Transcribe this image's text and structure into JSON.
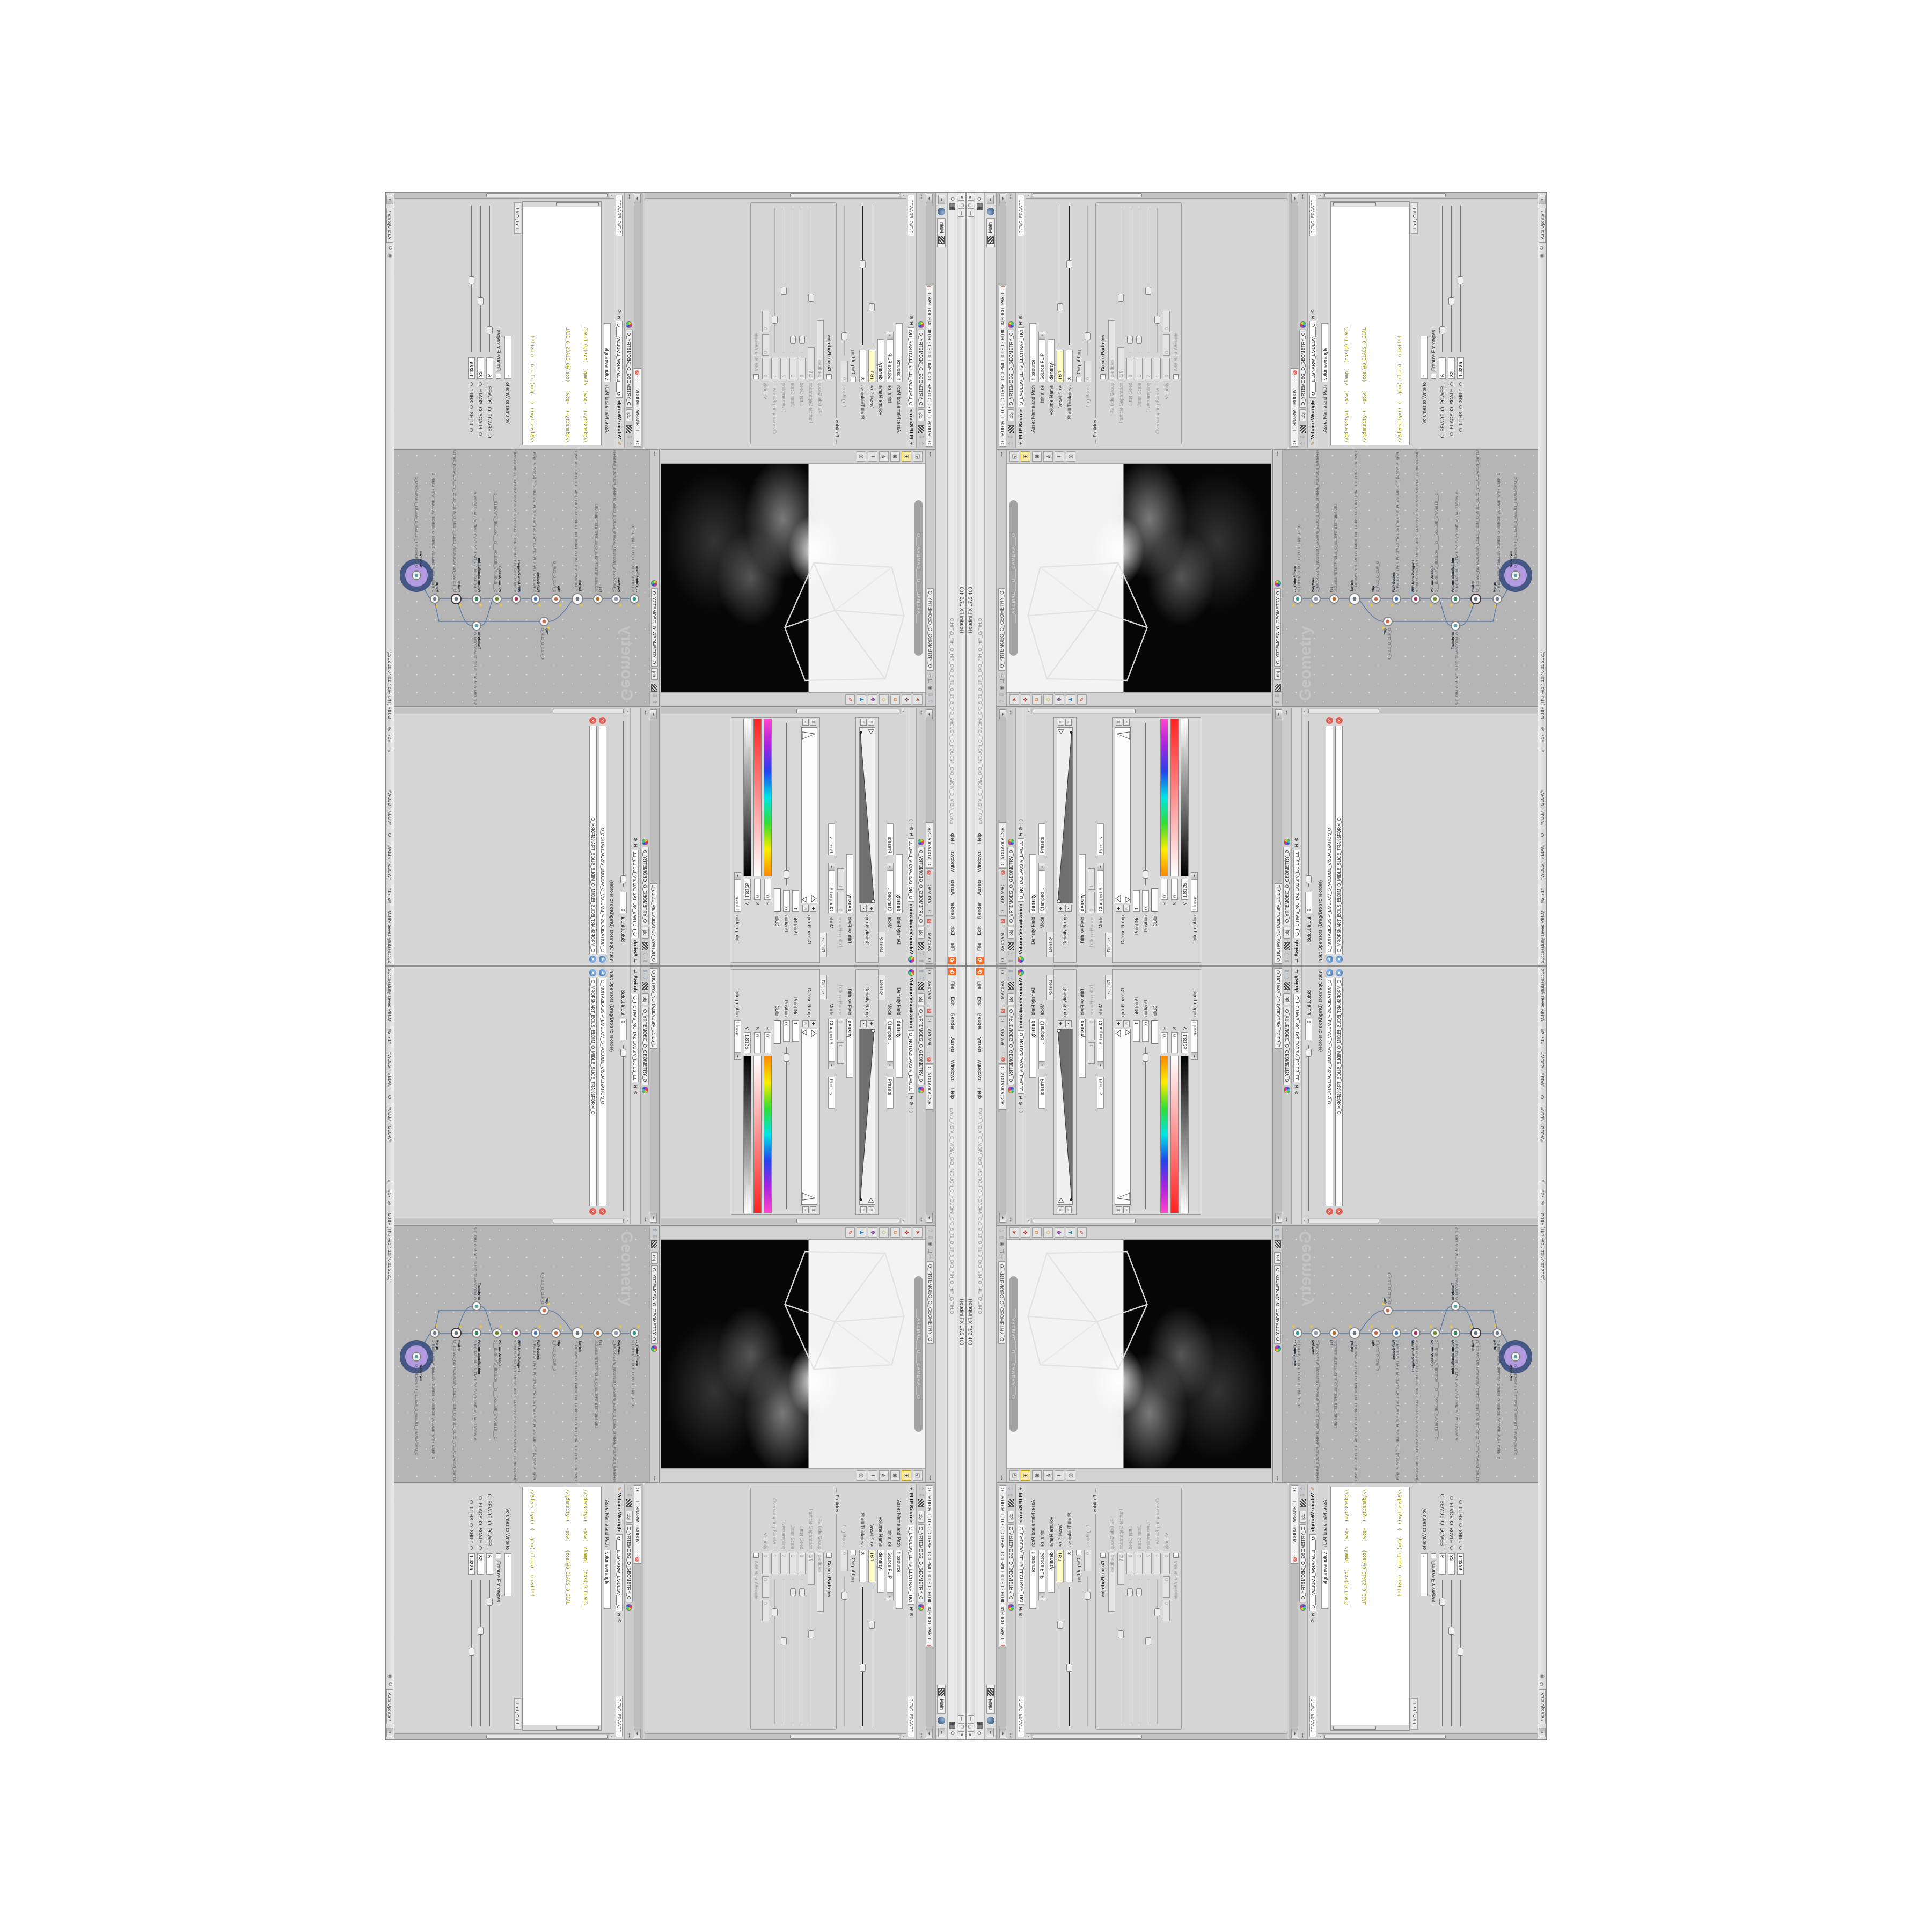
{
  "colors": {
    "accent_orange": "#f26722",
    "wire_blue": "#5b7da8",
    "selected_ring": "#3c4f80",
    "selected_fill": "#b39ae0",
    "code_olive": "#8f8f00",
    "code_keyword_teal": "#0e8a8a",
    "modified_value_bg": "#ffffc8",
    "network_bg": "#b5b5b5"
  },
  "window": {
    "title": "Houdini FX 17.5.460",
    "menu": {
      "file": "File",
      "edit": "Edit",
      "render": "Render",
      "assets": "Assets",
      "windows": "Windows",
      "help": "Help"
    },
    "title_path": "c:/o/o_AIDIV_O_VIDIA_O/O_INIDUOH_O_HOUDINI_O/O_5_71_O_17_5_O/O_PIH_O_HIP_O/PIH.O",
    "menu_right_label": "O",
    "shelf_desktop": "Main"
  },
  "status": {
    "saved": "Successfully saved PIH.O___#5_71#___#WOLG#_#BDV#___O___#VDB#_#GLOW#",
    "file": "#___#17_5#___O.HIP (Thu Feb 4 10:46:01 2021)",
    "auto_update": "Auto Update"
  },
  "nav": {
    "net": "obj",
    "path": "O_YRTEMOEG_O_GEOMETRY_O"
  },
  "viewport": {
    "camera_bar": "___AREMAC___O___CAMERA___O"
  },
  "network": {
    "watermark": "Geometry",
    "nodes": [
      {
        "name": "ae_CubeSphere",
        "path": "O_EREHPS_EBUC_O_CUBE_SPHERE_O"
      },
      {
        "name": "PolyWire",
        "path": "O_EMARFERIW_NOGYLOP_EREHPS_EBUC_O_CUBE_SPHERE_POLYGON_WIREFRAME_O"
      },
      {
        "name": "File",
        "path": "JBO.MB3-PETS-TRPDILS_O_SLIDPRT-STEP-3BM.OBJ"
      },
      {
        "name": "Switch",
        "path": "O_HCTIWS_YRTEMOEG_LANRETXE_LANRETNI_O_INTERNAL_EXTERNAL_GEOMETRY_SWITCH_O"
      },
      {
        "name": "Clip",
        "path": "O_PILC_O_CLIP_O"
      },
      {
        "name": "Clip",
        "path": "O_PILC_O_CLIP_O"
      },
      {
        "name": "FLIP Source",
        "path": "O_EMULOV_LEHS_ELCITRAP_TICILPMI_DIULF_O_FLUID_IMPLICIT_PARTICLE_SHEL_VOLUME_O"
      },
      {
        "name": "VDB from Polygons",
        "path": "O_SNOGYLOP_YRTEMOEG_MORF_EMULOV_BDV_O_VDB_VOLUME_FROM_GEOMETRY_POLYGONS_O"
      },
      {
        "name": "Volume Wrangle",
        "path": "O___ELGNARW_EMULOV___O___VOLUME_WRANGLE___O"
      },
      {
        "name": "Volume Visualization",
        "path": "O_NOITAZILAUSIV_EMULOV_O_VOLUME_VISUALIZATION_O"
      },
      {
        "name": "Transform",
        "path": "O_MROFSNART_ECILS_ELDIM_O_MIDLE_SLICE_TRANSFORM_O"
      },
      {
        "name": "Switch",
        "path": "O_HCTIWS_NOITAZILAUSIV_ECILS_ELDIM_O_MIDLE_SLICE_VISUALIZATION_SWITCH_O"
      },
      {
        "name": "Merge",
        "path": "O_RESU_HTIW_EMULOV_EGREM_O_MERGE_VOLUME_WITH_USER_O"
      },
      {
        "name": "Transform",
        "path": "O_MROFSNART_TLUSER_O_RESULT_TRANSFORM_O"
      }
    ]
  },
  "viz": {
    "tabs": [
      "O___ARTNAM__...",
      "O___AREMAC__...",
      "O_NOITAZILAUSIV..."
    ],
    "type": "Volume Visualization",
    "name": "O_NOITAZILAUSIV_EMULO",
    "density_field_label": "Density Field",
    "density_field_value": "density",
    "mode_label": "Mode",
    "mode_value": "Clamped...",
    "presets": "Presets",
    "density_tab": "Density",
    "density_ramp_label": "Density Ramp",
    "diffuse_field_label": "Diffuse Field",
    "diffuse_field_value": "density",
    "diffuse_range_label": "Diffuse Range",
    "diffuse_range_min": "0",
    "diffuse_range_max": "1",
    "mode2_label": "Mode",
    "mode2_value": "Clamped R...",
    "presets2": "Presets",
    "diffuse_tab": "Diffuse",
    "diffuse_ramp_label": "Diffuse Ramp",
    "point_label": "Point No.",
    "point_value": "1",
    "position_label": "Position",
    "position_value": "0",
    "color_label": "Color",
    "h_label": "H",
    "h_value": "0",
    "s_label": "S",
    "s_value": "0",
    "v_label": "V",
    "v_value": "1.8125",
    "interp_label": "Interpolation",
    "interp_value": "Linear"
  },
  "switcher": {
    "tab": "O_HCTIWS_NOITAZILAUSIV_ECILS_EL...",
    "type": "Switch",
    "name": "O_HCTIWS_NOITAZILAUSIV_ECILS_EL",
    "select_label": "Select Input",
    "select_value": "0",
    "ops_label": "Input Operators (Drag/Drop to reorder)",
    "ops": [
      "O_NOITAZILAUSIV_EMULOV_O_VOLUME_VISUALIZATION_O",
      "O_MROFSNART_ECILS_ELDIM_O_MIDLE_SLICE_TRANSFORM_O"
    ]
  },
  "flip": {
    "tab": "O_EMULOV_LEHS_ELCITRAP_TICILPMI_DIULF_O_FLUID_IMPLICIT_PARTI...",
    "type": "FLIP Source",
    "name": "O_EMULOV_LEHS_ELCITRAP_TICI",
    "path_field": "C:/O/O_ERAWTF...",
    "asset_label": "Asset Name and Path",
    "asset_value": "flipsource",
    "initialize_label": "Initialize",
    "initialize_value": "Source FLIP",
    "volume_name_label": "Volume Name",
    "volume_name_value": "density",
    "voxel_label": "Voxel Size",
    "voxel_value": "1/27",
    "shell_label": "Shell Thickness",
    "shell_value": "3",
    "output_fog_label": "Output Fog",
    "fog_boost_label": "Fog Boost",
    "fog_boost_value": "0",
    "particles_group": "Particles",
    "create_particles_label": "Create Particles",
    "particle_group_label": "Particle Group",
    "particle_group_value": "particles",
    "particle_sep_label": "Particle Separation",
    "particle_sep_value": "1/9",
    "jitter_seed_label": "Jitter Seed",
    "jitter_seed_value": "0",
    "jitter_scale_label": "Jitter Scale",
    "jitter_scale_value": "0",
    "oversampling_label": "Oversampling",
    "oversampling_value": "2",
    "oversampling_bw_label": "Oversampling Bandwi...",
    "oversampling_bw_value": "1",
    "velocity_label": "Velocity",
    "velocity_value": "0",
    "add_rest_label": "Add Rest Attribute"
  },
  "wrangle": {
    "tab": "O____ELGNARW_EMULOV____O",
    "type": "Volume Wrangle",
    "name": "O____ELGNARW_EMULOV____O",
    "path_field": "C:/O/O_ERAWTF...",
    "asset_label": "Asset Name and Path",
    "asset_value": "volumewrangle",
    "code": [
      "//@density=(  -pow(  clamp(  (cos(@O_ELACS_",
      "//@density=(  -pow(   (cos(@O_ELACS_O_SCAL",
      "//@density=(( (  -pow( clamp(  (cos(1*$",
      "//@density=(  -pow(   (cos((clamp(@O_TFIHS",
      "//@density=(( (  -pow( clamp(  (cos( c",
      "//@density=(( (pow((        1./",
      "//@density=((pow((   1./ (1.-clamp("
    ],
    "code_last_pre": "@density=(( ((",
    "code_last_kw": "pow",
    "code_last_post": "((   1./ (",
    "lncol": "Ln 1, Col 1",
    "volumes_label": "Volumes to Write to",
    "volumes_value": "*",
    "enforce_label": "Enforce Prototypes",
    "param_power_label": "O_REWOP_O_POWER...",
    "param_power_value": "6",
    "param_scale_label": "O_ELACS_O_SCALE_O",
    "param_scale_value": "32",
    "param_shift_label": "O_TFIHS_O_SHIFT_O",
    "param_shift_value": "1.4375"
  }
}
